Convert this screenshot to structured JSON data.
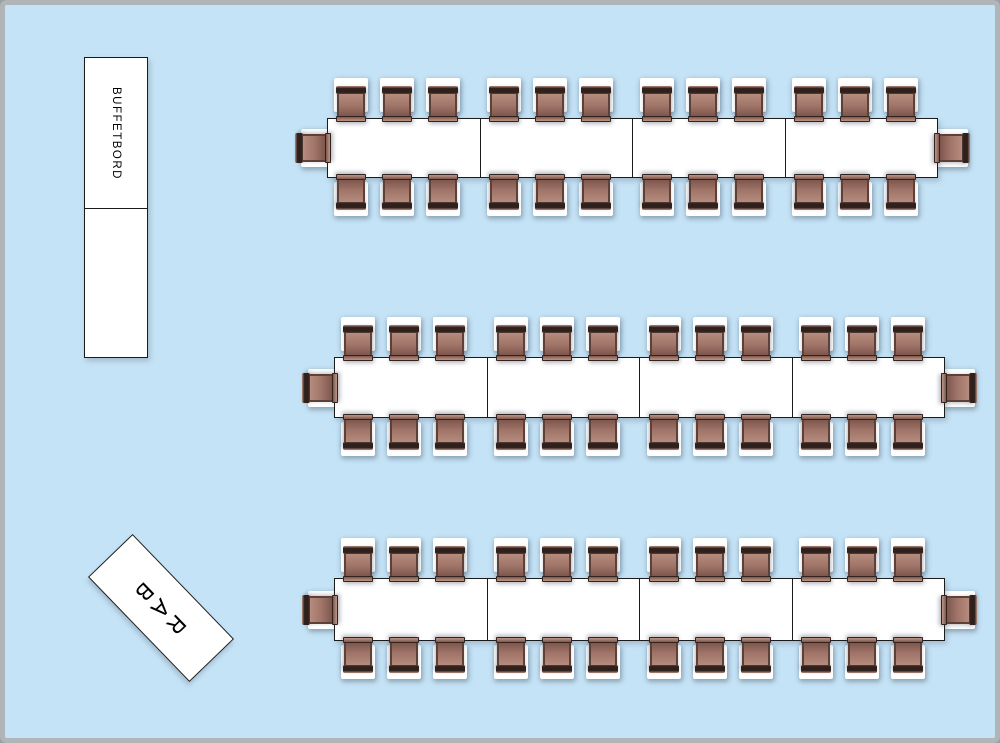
{
  "floor_plan": {
    "colors": {
      "floor": "#c5e3f6",
      "frame": "#b2b5b8",
      "furniture_fill": "#ffffff",
      "outline": "#1b1b1b",
      "chair_seat": "#a07468",
      "chair_seat_light": "#b58c7e",
      "chair_seat_dark": "#7d574c",
      "chair_back": "#2f201c"
    },
    "objects": {
      "buffet": {
        "label": "BUFFETBORD",
        "x": 79,
        "y": 52,
        "width": 64,
        "height": 301,
        "sections": 2,
        "first_section_height": 151
      },
      "bar": {
        "label": "BAR",
        "center_x": 155.5,
        "center_y": 603,
        "width": 146,
        "height": 62,
        "rotation_deg": 46
      },
      "banquet_tables": [
        {
          "name": "banquet-table-1",
          "x": 322,
          "y": 113,
          "width": 611,
          "height": 60,
          "segments": 4,
          "chairs_top": 12,
          "chairs_bottom": 12,
          "chairs_ends": 2,
          "total_seats": 26
        },
        {
          "name": "banquet-table-2",
          "x": 329,
          "y": 352,
          "width": 611,
          "height": 61,
          "segments": 4,
          "chairs_top": 12,
          "chairs_bottom": 12,
          "chairs_ends": 2,
          "total_seats": 26
        },
        {
          "name": "banquet-table-3",
          "x": 329,
          "y": 573,
          "width": 611,
          "height": 63,
          "segments": 4,
          "chairs_top": 12,
          "chairs_bottom": 12,
          "chairs_ends": 2,
          "total_seats": 26
        }
      ],
      "total_seats": 78
    }
  }
}
